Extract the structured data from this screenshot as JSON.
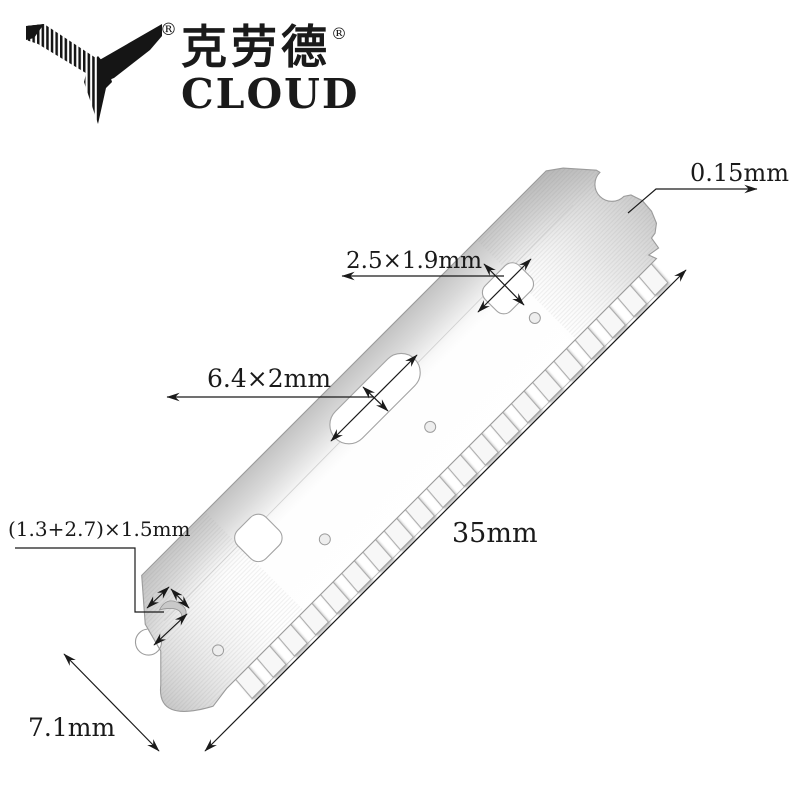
{
  "brand": {
    "name_cn": "克劳德",
    "name_en": "CLOUD",
    "registered_mark": "®"
  },
  "blade": {
    "teeth_count": 20
  },
  "annotations": {
    "thickness": "0.15mm",
    "small_hole": "2.5×1.9mm",
    "long_slot": "6.4×2mm",
    "end_notch": "(1.3+2.7)×1.5mm",
    "length": "35mm",
    "width": "7.1mm"
  },
  "colors": {
    "background": "#ffffff",
    "annotation_line": "#1a1a1a",
    "annotation_text": "#1a1a1a",
    "blade_outline": "#9b9b9b",
    "blade_light": "#f8f8f8",
    "blade_dark": "#bfbfbf",
    "logo": "#151515"
  }
}
